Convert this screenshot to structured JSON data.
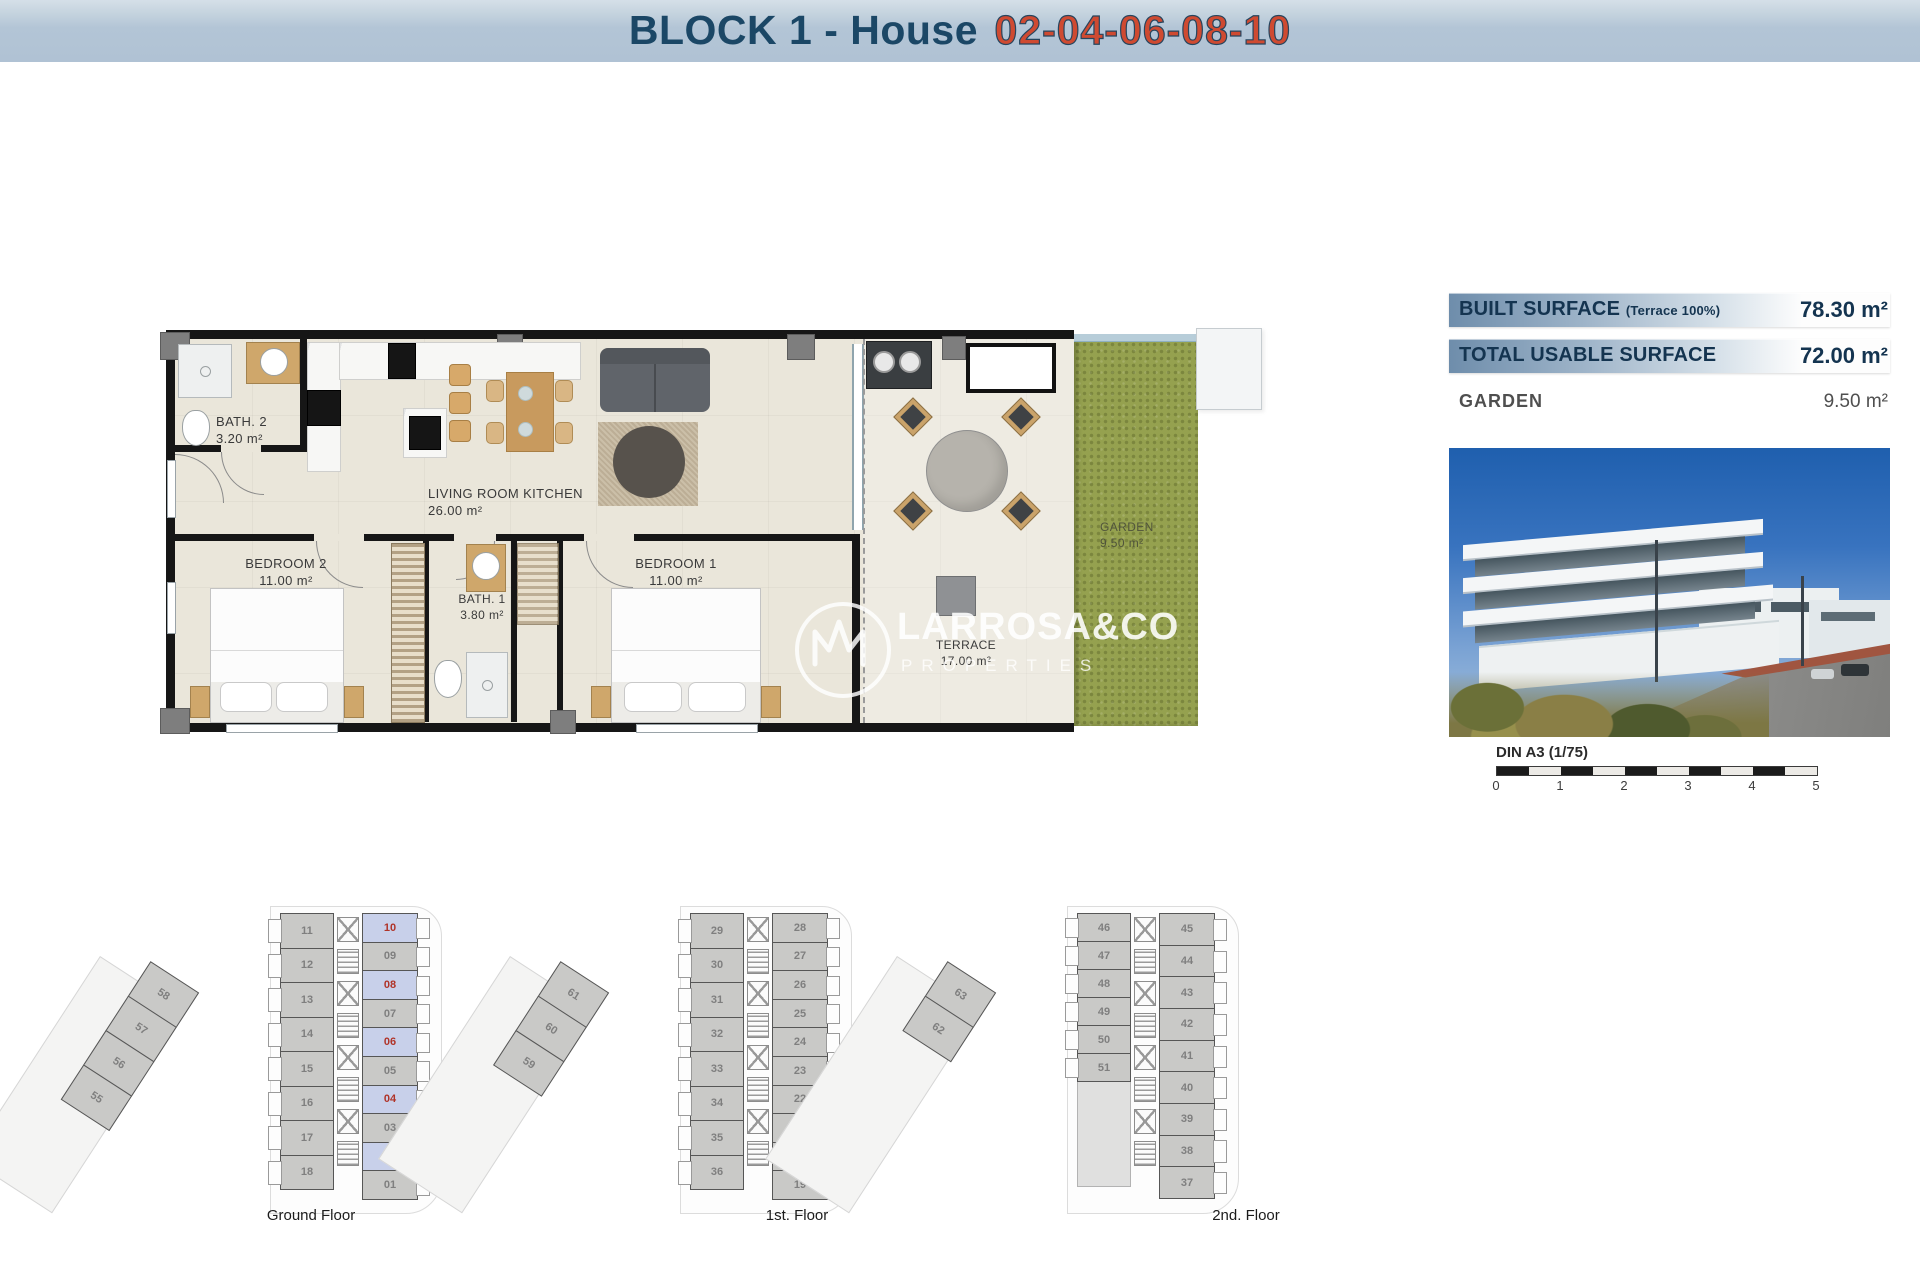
{
  "title": {
    "prefix": "BLOCK 1 - House",
    "numbers": "02-04-06-08-10"
  },
  "info_panel": {
    "rows": [
      {
        "label": "BUILT SURFACE",
        "note": "(Terrace 100%)",
        "value": "78.30 m²"
      },
      {
        "label": "TOTAL USABLE SURFACE",
        "note": "",
        "value": "72.00 m²"
      },
      {
        "label": "GARDEN",
        "note": "",
        "value": "9.50 m²"
      }
    ]
  },
  "floor_plan": {
    "rooms": {
      "bath2": {
        "name": "BATH. 2",
        "area": "3.20 m²"
      },
      "living": {
        "name": "LIVING ROOM KITCHEN",
        "area": "26.00 m²"
      },
      "bedroom2": {
        "name": "BEDROOM 2",
        "area": "11.00 m²"
      },
      "bath1": {
        "name": "BATH. 1",
        "area": "3.80 m²"
      },
      "bedroom1": {
        "name": "BEDROOM 1",
        "area": "11.00 m²"
      },
      "terrace": {
        "name": "TERRACE",
        "area": "17.00 m²"
      },
      "garden": {
        "name": "GARDEN",
        "area": "9.50 m²"
      }
    }
  },
  "watermark": {
    "brand": "LARROSA&CO",
    "sub": "PROPERTIES"
  },
  "scale_bar": {
    "label": "DIN A3 (1/75)",
    "ticks": [
      "0",
      "1",
      "2",
      "3",
      "4",
      "5"
    ]
  },
  "floors": [
    {
      "caption": "Ground Floor",
      "left_units": [
        "11",
        "12",
        "13",
        "14",
        "15",
        "16",
        "17",
        "18"
      ],
      "right_units": [
        "10",
        "09",
        "08",
        "07",
        "06",
        "05",
        "04",
        "03",
        "02",
        "01"
      ],
      "highlighted": [
        "10",
        "08",
        "06",
        "04",
        "02"
      ],
      "wing_units": [
        "58",
        "57",
        "56",
        "55"
      ]
    },
    {
      "caption": "1st. Floor",
      "left_units": [
        "29",
        "30",
        "31",
        "32",
        "33",
        "34",
        "35",
        "36"
      ],
      "right_units": [
        "28",
        "27",
        "26",
        "25",
        "24",
        "23",
        "22",
        "21",
        "20",
        "19"
      ],
      "highlighted": [],
      "wing_units": [
        "61",
        "60",
        "59"
      ]
    },
    {
      "caption": "2nd. Floor",
      "left_units": [
        "46",
        "47",
        "48",
        "49",
        "50",
        "51"
      ],
      "right_units": [
        "45",
        "44",
        "43",
        "42",
        "41",
        "40",
        "39",
        "38",
        "37"
      ],
      "highlighted": [],
      "wing_units": [
        "63",
        "62"
      ]
    }
  ],
  "colors": {
    "title_navy": "#1b4766",
    "title_red": "#cf4a31",
    "info_navy": "#143450",
    "highlight_unit_bg": "#c8d0ea",
    "highlight_unit_number": "#b03328",
    "garden_green": "#95a14f"
  }
}
